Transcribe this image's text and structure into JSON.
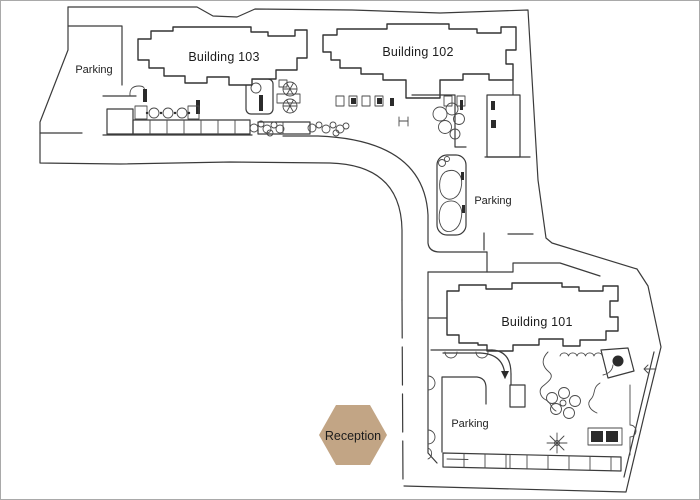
{
  "title": "Apartment community site plan",
  "labels": {
    "building_103": "Building 103",
    "building_102": "Building 102",
    "building_101": "Building 101",
    "parking_top_left": "Parking",
    "parking_courtyard": "Parking",
    "parking_bottom": "Parking",
    "reception": "Reception"
  },
  "colors": {
    "line": "#3b3b3b",
    "background": "#ffffff",
    "frame": "#a9a9a9",
    "reception_fill": "#c2a585",
    "reception_text": "#1c1c1c"
  },
  "icons": {
    "reception_marker": "hexagon-marker",
    "ponds": "kidney-pond",
    "trees": "tree-circle-cluster",
    "palm": "palm-sun-icon",
    "pool_loungers": "lounger-icon",
    "umbrella_tables": "spoked-table-icon",
    "parking_stalls": "stall-row"
  }
}
